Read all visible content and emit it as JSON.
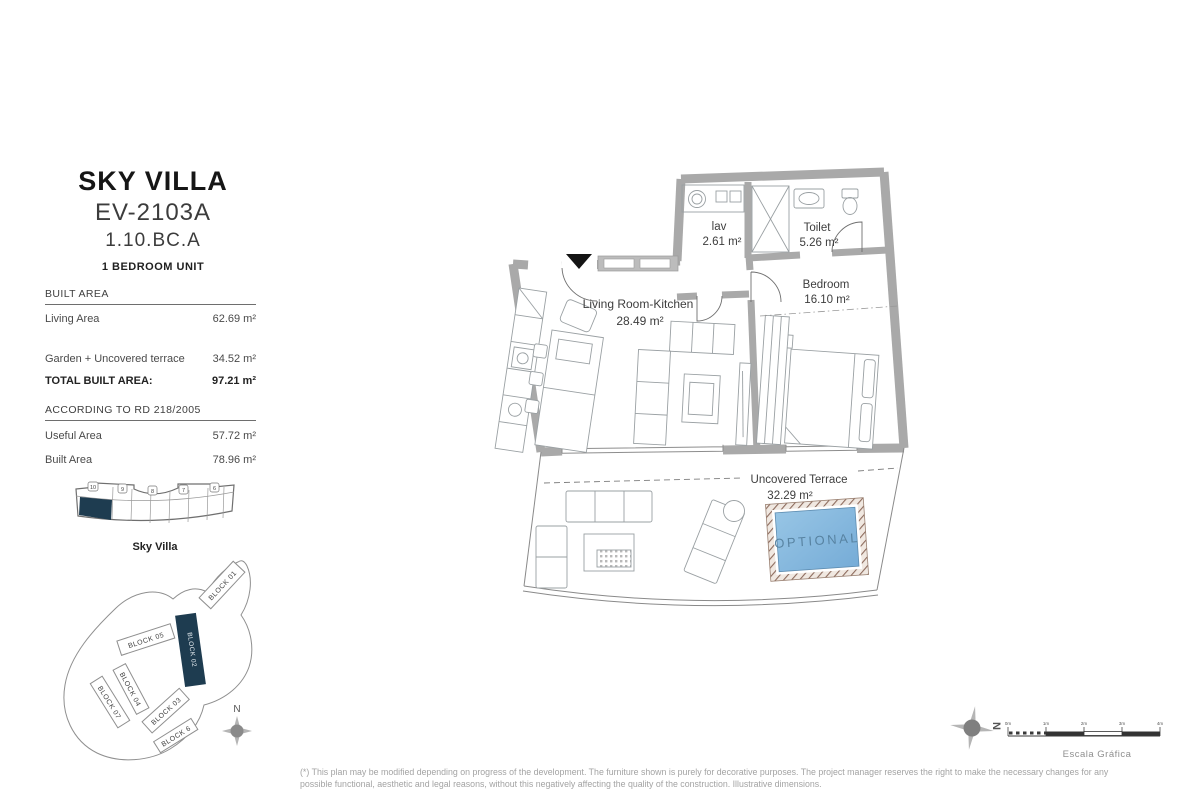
{
  "header": {
    "title": "SKY VILLA",
    "code": "EV-2103A",
    "unit": "1.10.BC.A",
    "subtitle": "1 BEDROOM UNIT"
  },
  "built_area": {
    "heading": "BUILT AREA",
    "rows": [
      {
        "label": "Living Area",
        "value": "62.69 m²"
      },
      {
        "label": "Garden + Uncovered terrace",
        "value": "34.52 m²"
      },
      {
        "label": "TOTAL BUILT AREA:",
        "value": "97.21 m²"
      }
    ]
  },
  "rd218": {
    "heading": "ACCORDING TO RD 218/2005",
    "rows": [
      {
        "label": "Useful Area",
        "value": "57.72 m²"
      },
      {
        "label": "Built Area",
        "value": "78.96 m²"
      }
    ]
  },
  "strip": {
    "caption": "Sky Villa",
    "unit_numbers": [
      "10",
      "9",
      "8",
      "7",
      "6"
    ]
  },
  "site": {
    "compass_letter": "N",
    "blocks": [
      {
        "label": "BLOCK 01"
      },
      {
        "label": "BLOCK 02"
      },
      {
        "label": "BLOCK 05"
      },
      {
        "label": "BLOCK 04"
      },
      {
        "label": "BLOCK 07"
      },
      {
        "label": "BLOCK 03"
      },
      {
        "label": "BLOCK 6"
      }
    ]
  },
  "plan": {
    "rooms": [
      {
        "name": "lav",
        "area": "2.61 m²"
      },
      {
        "name": "Toilet",
        "area": "5.26 m²"
      },
      {
        "name": "Bedroom",
        "area": "16.10 m²"
      },
      {
        "name": "Living Room-Kitchen",
        "area": "28.49 m²"
      },
      {
        "name": "Uncovered Terrace",
        "area": "32.29 m²"
      }
    ],
    "pool_label": "OPTIONAL"
  },
  "footer": {
    "compass_letter": "N",
    "scale_labels": [
      "0m",
      "1m",
      "2m",
      "3m",
      "4m"
    ],
    "scale_caption": "Escala Gráfica",
    "disclaimer_lines": [
      "(*) This plan may be modified depending on progress of the development. The furniture shown is purely for decorative purposes. The project manager reserves the right to make the necessary changes for any",
      "possible functional, aesthetic and legal reasons, without this negatively affecting the quality of the construction. Illustrative dimensions."
    ]
  },
  "colors": {
    "wall": "#a9a9a9",
    "pool_blue": "#85b9de",
    "accent_dark": "#1e3c50",
    "disclaimer_gray": "#a3a3a3"
  }
}
